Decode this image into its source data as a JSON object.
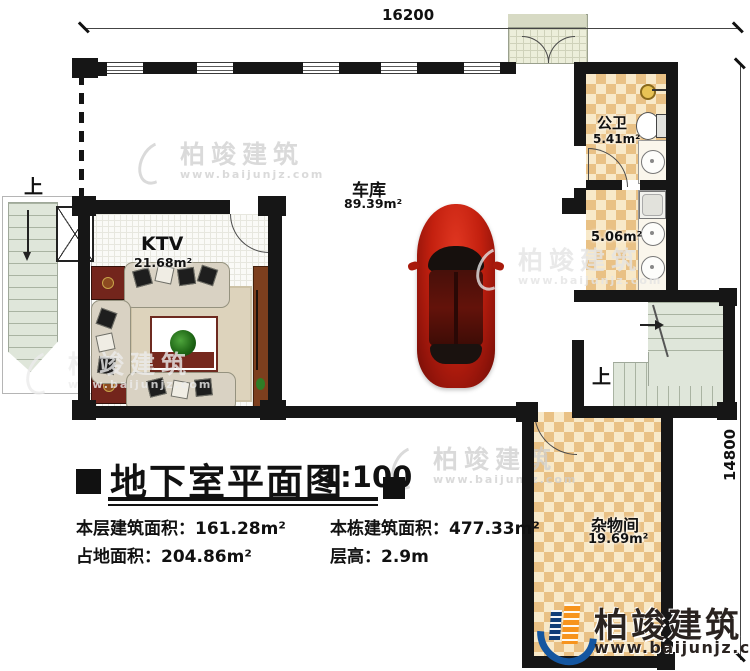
{
  "title": {
    "text": "地下室平面图",
    "scale": "1:100"
  },
  "stats": {
    "floor_area_label": "本层建筑面积：",
    "floor_area": "161.28m²",
    "total_area_label": "本栋建筑面积：",
    "total_area": "477.33m²",
    "land_area_label": "占地面积：",
    "land_area": "204.86m²",
    "floor_height_label": "层高：",
    "floor_height": "2.9m"
  },
  "dimensions": {
    "top": "16200",
    "right": "14800"
  },
  "rooms": {
    "garage": {
      "name": "车库",
      "area": "89.39m²"
    },
    "ktv": {
      "name": "KTV",
      "area": "21.68m²"
    },
    "bathroom": {
      "name": "公卫",
      "area": "5.41m²"
    },
    "washroom": {
      "area": "5.06m²"
    },
    "storage": {
      "name": "杂物间",
      "area": "19.69m²"
    }
  },
  "stairs": {
    "up_left": "上",
    "up_right": "上"
  },
  "watermark": {
    "name": "柏竣建筑",
    "url": "www.baijunjz.com"
  },
  "logo": {
    "name": "柏竣建筑",
    "url": "www.baijunjz.com"
  },
  "colors": {
    "wall": "#161616",
    "tile": "#e9c185",
    "stair": "#dfe6da",
    "car": "#c3200f",
    "logo_blue": "#1456a0",
    "logo_orange": "#f7941d"
  }
}
